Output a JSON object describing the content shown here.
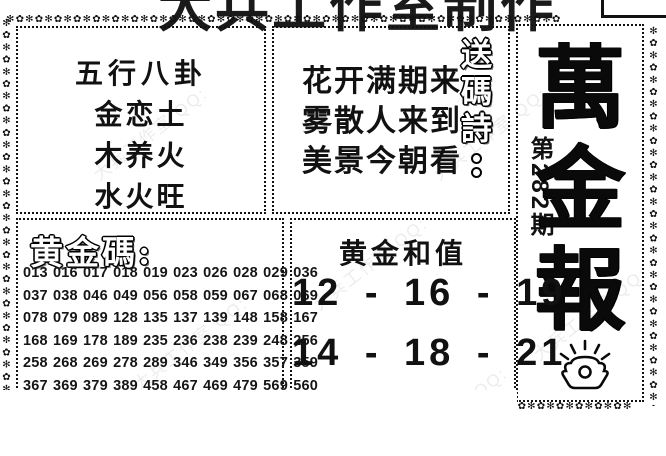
{
  "header": {
    "title": "大兵工作室制作"
  },
  "watermark": {
    "text": "大兵工作室 QQ:"
  },
  "decoration": {
    "top": "✻✿✻✿✻✿✻✿✻✿✻✿✻✿✻✿✻✿✻✿✻✿✻✿✻✿✻✿✻✿✻✿✻✿✻✿✻✿✻✿✻✿✻✿✻✿✻✿✻✿✻✿✻✿✻✿✻✿",
    "left": "✻✿✻✿✻✿✻✿✻✿✻✿✻✿✻✿✻✿✻✿✻✿✻✿✻✿✻✿✻✿✻✿✻✿✻",
    "right": "✻✿✻✿✻✿✻✿✻✿✻✿✻✿✻✿✻✿✻✿✻✿✻✿✻✿✻✿✻✿✻✿✻✿✻",
    "bottom_right": "✻✿✻✿✻✿✻✿✻✿✻✿✻"
  },
  "wuxing": {
    "title": "五行八卦",
    "lines": [
      "金恋土",
      "木养火",
      "水火旺"
    ]
  },
  "poem": {
    "label": "送碼詩",
    "lines": [
      "花开满期来",
      "雾散人来到",
      "美景今朝看"
    ]
  },
  "brand": {
    "name": "萬金報",
    "chars": [
      "萬",
      "金",
      "報"
    ],
    "issue": "第282期",
    "icon": "gold-ingot"
  },
  "golden_codes": {
    "title": "黄金碼:",
    "rows": [
      "013 016 017 018 019 023 026 028 029 036",
      "037 038 046 049 056 058 059 067 068 069",
      "078 079 089 128 135 137 139 148 158 167",
      "168 169 178 189 235 236 238 239 248 256",
      "258 268 269 278 289 346 349 356 357 359",
      "367 369 379 389 458 467 469 479 569 560"
    ]
  },
  "golden_sum": {
    "title": "黄金和值",
    "lines": [
      "12 - 16 - 19",
      "14 - 18 - 21"
    ],
    "clipped": "· · ·"
  },
  "colors": {
    "ink": "#111111",
    "paper": "#ffffff",
    "watermark": "#999999"
  }
}
